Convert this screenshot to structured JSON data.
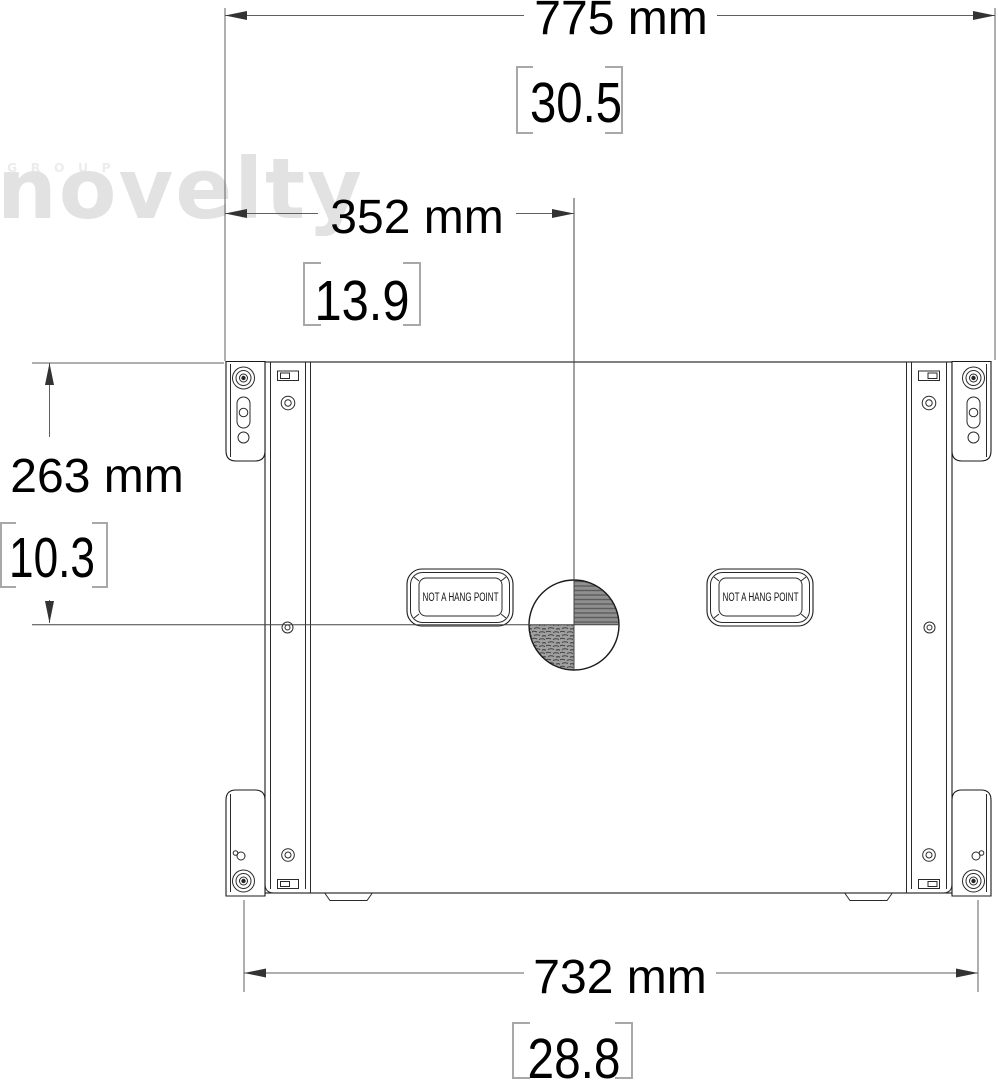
{
  "watermark": {
    "group": "GROUP",
    "brand": "novelty"
  },
  "annotations": {
    "overall_width": {
      "mm": "775 mm",
      "inches": "30.5"
    },
    "cog_offset_x": {
      "mm": "352 mm",
      "inches": "13.9"
    },
    "cog_offset_y": {
      "mm": "263 mm",
      "inches": "10.3"
    },
    "bottom_width": {
      "mm": "732 mm",
      "inches": "28.8"
    }
  },
  "cabinet": {
    "handle_left_label": "NOT A HANG POINT",
    "handle_right_label": "NOT A HANG POINT"
  },
  "colors": {
    "outline": "#1a1a1a",
    "dimension_line": "#5f5f5f",
    "text": "#000000",
    "bracket_gray": "#a8a8a8",
    "watermark_gray": "#e2e2e2",
    "hatch_gray": "#8f8f8f"
  }
}
